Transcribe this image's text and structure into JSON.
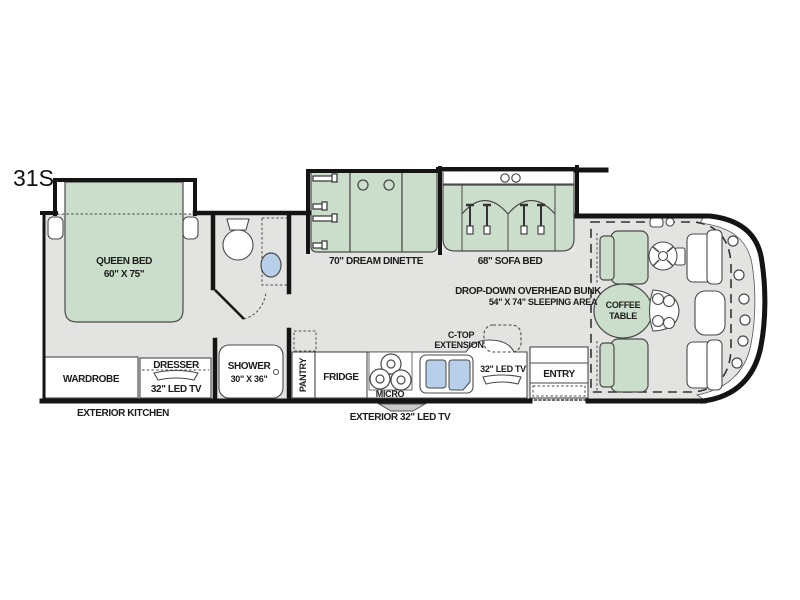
{
  "model": "31S",
  "colors": {
    "furniture_green": "#cbdecb",
    "floor_gray": "#e3e4e2",
    "slideout_gray": "#e9eae8",
    "sink_blue": "#b7cfe9",
    "wall_black": "#141414"
  },
  "rooms": {
    "bedroom": {
      "bed_name": "QUEEN BED",
      "bed_size": "60\" X 75\"",
      "wardrobe": "WARDROBE",
      "dresser": "DRESSER",
      "dresser_tv": "32\" LED TV"
    },
    "bathroom": {
      "shower_name": "SHOWER",
      "shower_size": "30\" X 36\""
    },
    "kitchen": {
      "pantry": "PANTRY",
      "fridge": "FRIDGE",
      "micro": "MICRO",
      "ctop_line1": "C-TOP",
      "ctop_line2": "EXTENSION",
      "tv": "32\" LED TV"
    },
    "living": {
      "dinette": "70\" DREAM DINETTE",
      "sofa": "68\" SOFA BED",
      "bunk_line1": "DROP-DOWN OVERHEAD BUNK",
      "bunk_line2": "54\" X 74\" SLEEPING AREA",
      "coffee_line1": "COFFEE",
      "coffee_line2": "TABLE"
    },
    "entry": {
      "label": "ENTRY"
    },
    "exterior": {
      "kitchen": "EXTERIOR KITCHEN",
      "tv": "EXTERIOR 32\" LED TV"
    }
  }
}
